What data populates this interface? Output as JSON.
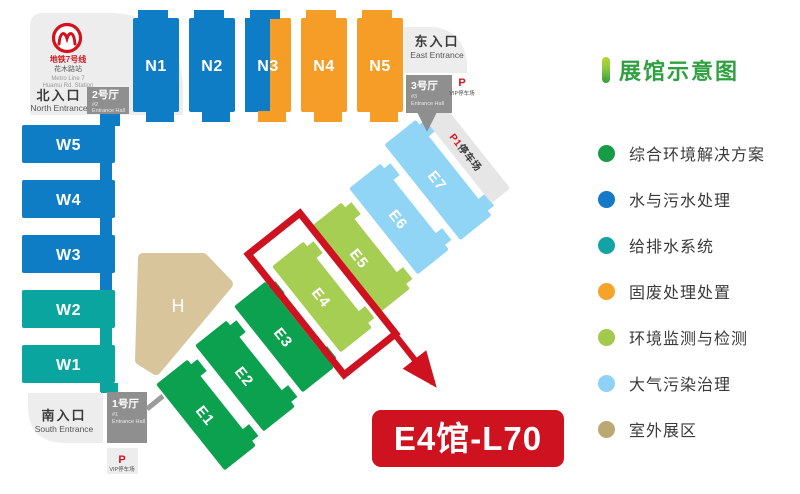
{
  "legend": {
    "title": "展馆示意图",
    "items": [
      {
        "label": "综合环境解决方案",
        "color": "#169b47"
      },
      {
        "label": "水与污水处理",
        "color": "#1479c8"
      },
      {
        "label": "给排水系统",
        "color": "#12a3a4"
      },
      {
        "label": "固废处理处置",
        "color": "#f5a32b"
      },
      {
        "label": "环境监测与检测",
        "color": "#a3c94d"
      },
      {
        "label": "大气污染治理",
        "color": "#8ed3f5"
      },
      {
        "label": "室外展区",
        "color": "#bca873"
      }
    ]
  },
  "map": {
    "metro": {
      "line1": "地铁7号线",
      "line2": "花木路站",
      "line3": "Metro Line 7",
      "line4": "Huamu Rd. Station"
    },
    "entrances": {
      "north_cn": "北入口",
      "north_en": "North Entrance",
      "east_cn": "东入口",
      "east_en": "East Entrance",
      "south_cn": "南入口",
      "south_en": "South Entrance"
    },
    "entrance_halls": {
      "hall2": {
        "name": "2号厅",
        "num": "#2",
        "en": "Entrance Hall"
      },
      "hall3": {
        "name": "3号厅",
        "num": "#3",
        "en": "Entrance Hall"
      },
      "hall1": {
        "name": "1号厅",
        "num": "#1",
        "en": "Entrance Hall"
      }
    },
    "parking": {
      "vip_p": "P",
      "vip_label": "VIP停车场",
      "p1": "P1",
      "p1_label": "停车场"
    },
    "colors": {
      "blue": "#0e7dc6",
      "teal": "#0ba5a0",
      "orange": "#f59d27",
      "green": "#0ba14e",
      "lightgreen": "#a5ce53",
      "lightblue": "#90d5f6",
      "tan": "#d8c59b",
      "darkgray": "#8f8f8f",
      "lightgray": "#ededed",
      "red": "#ce1220"
    },
    "halls": [
      {
        "id": "N1",
        "label": "N1",
        "type": "vertical",
        "x": 133,
        "y": 18,
        "w": 46,
        "h": 94,
        "color": "#0e7dc6"
      },
      {
        "id": "N2",
        "label": "N2",
        "type": "vertical",
        "x": 189,
        "y": 18,
        "w": 46,
        "h": 94,
        "color": "#0e7dc6"
      },
      {
        "id": "N3",
        "label": "N3",
        "type": "vertical",
        "x": 245,
        "y": 18,
        "w": 46,
        "h": 94,
        "split": 0.54,
        "colors": [
          "#0e7dc6",
          "#f59d27"
        ],
        "color": "#0e7dc6"
      },
      {
        "id": "N4",
        "label": "N4",
        "type": "vertical",
        "x": 301,
        "y": 18,
        "w": 46,
        "h": 94,
        "color": "#f59d27"
      },
      {
        "id": "N5",
        "label": "N5",
        "type": "vertical",
        "x": 357,
        "y": 18,
        "w": 46,
        "h": 94,
        "color": "#f59d27"
      },
      {
        "id": "W5",
        "label": "W5",
        "type": "horizontal",
        "x": 22,
        "y": 125,
        "w": 93,
        "h": 38,
        "color": "#0e7dc6",
        "tabTop": true,
        "tabBottom": true
      },
      {
        "id": "W4",
        "label": "W4",
        "type": "horizontal",
        "x": 22,
        "y": 180,
        "w": 93,
        "h": 38,
        "color": "#0e7dc6",
        "tabBottom": true
      },
      {
        "id": "W3",
        "label": "W3",
        "type": "horizontal",
        "x": 22,
        "y": 235,
        "w": 93,
        "h": 38,
        "color": "#0e7dc6",
        "tabBottom": true
      },
      {
        "id": "W2",
        "label": "W2",
        "type": "horizontal",
        "x": 22,
        "y": 290,
        "w": 93,
        "h": 38,
        "color": "#0ba5a0",
        "tabBottom": true
      },
      {
        "id": "W1",
        "label": "W1",
        "type": "horizontal",
        "x": 22,
        "y": 345,
        "w": 93,
        "h": 38,
        "color": "#0ba5a0",
        "tabBottom": true,
        "tabShort": true
      },
      {
        "id": "E1",
        "label": "E1",
        "type": "diagonal",
        "cx": 206,
        "cy": 415,
        "len": 110,
        "wid": 40,
        "rot": 51.5,
        "color": "#0ba14e"
      },
      {
        "id": "E2",
        "label": "E2",
        "type": "diagonal",
        "cx": 245,
        "cy": 376,
        "len": 110,
        "wid": 40,
        "rot": 51.5,
        "color": "#0ba14e"
      },
      {
        "id": "E3",
        "label": "E3",
        "type": "diagonal",
        "cx": 284,
        "cy": 337,
        "len": 110,
        "wid": 40,
        "rot": 51.5,
        "color": "#0ba14e"
      },
      {
        "id": "E4",
        "label": "E4",
        "type": "diagonal",
        "cx": 322,
        "cy": 297,
        "len": 110,
        "wid": 40,
        "rot": 51.5,
        "color": "#a5ce53"
      },
      {
        "id": "E5",
        "label": "E5",
        "type": "diagonal",
        "cx": 360,
        "cy": 258,
        "len": 110,
        "wid": 40,
        "rot": 51.5,
        "color": "#a5ce53"
      },
      {
        "id": "E6",
        "label": "E6",
        "type": "diagonal",
        "cx": 399,
        "cy": 219,
        "len": 110,
        "wid": 40,
        "rot": 51.5,
        "color": "#90d5f6"
      },
      {
        "id": "E7",
        "label": "E7",
        "type": "diagonal",
        "cx": 438,
        "cy": 180,
        "len": 122,
        "wid": 40,
        "rot": 51.5,
        "color": "#90d5f6"
      },
      {
        "id": "H",
        "label": "H",
        "type": "polygon",
        "points": "143,258 203,258 228,284 156,370 140,360",
        "cx": 178,
        "cy": 312,
        "color": "#d8c59b"
      }
    ],
    "highlight": {
      "hall": "E4",
      "callout_label": "E4馆-L70"
    }
  }
}
